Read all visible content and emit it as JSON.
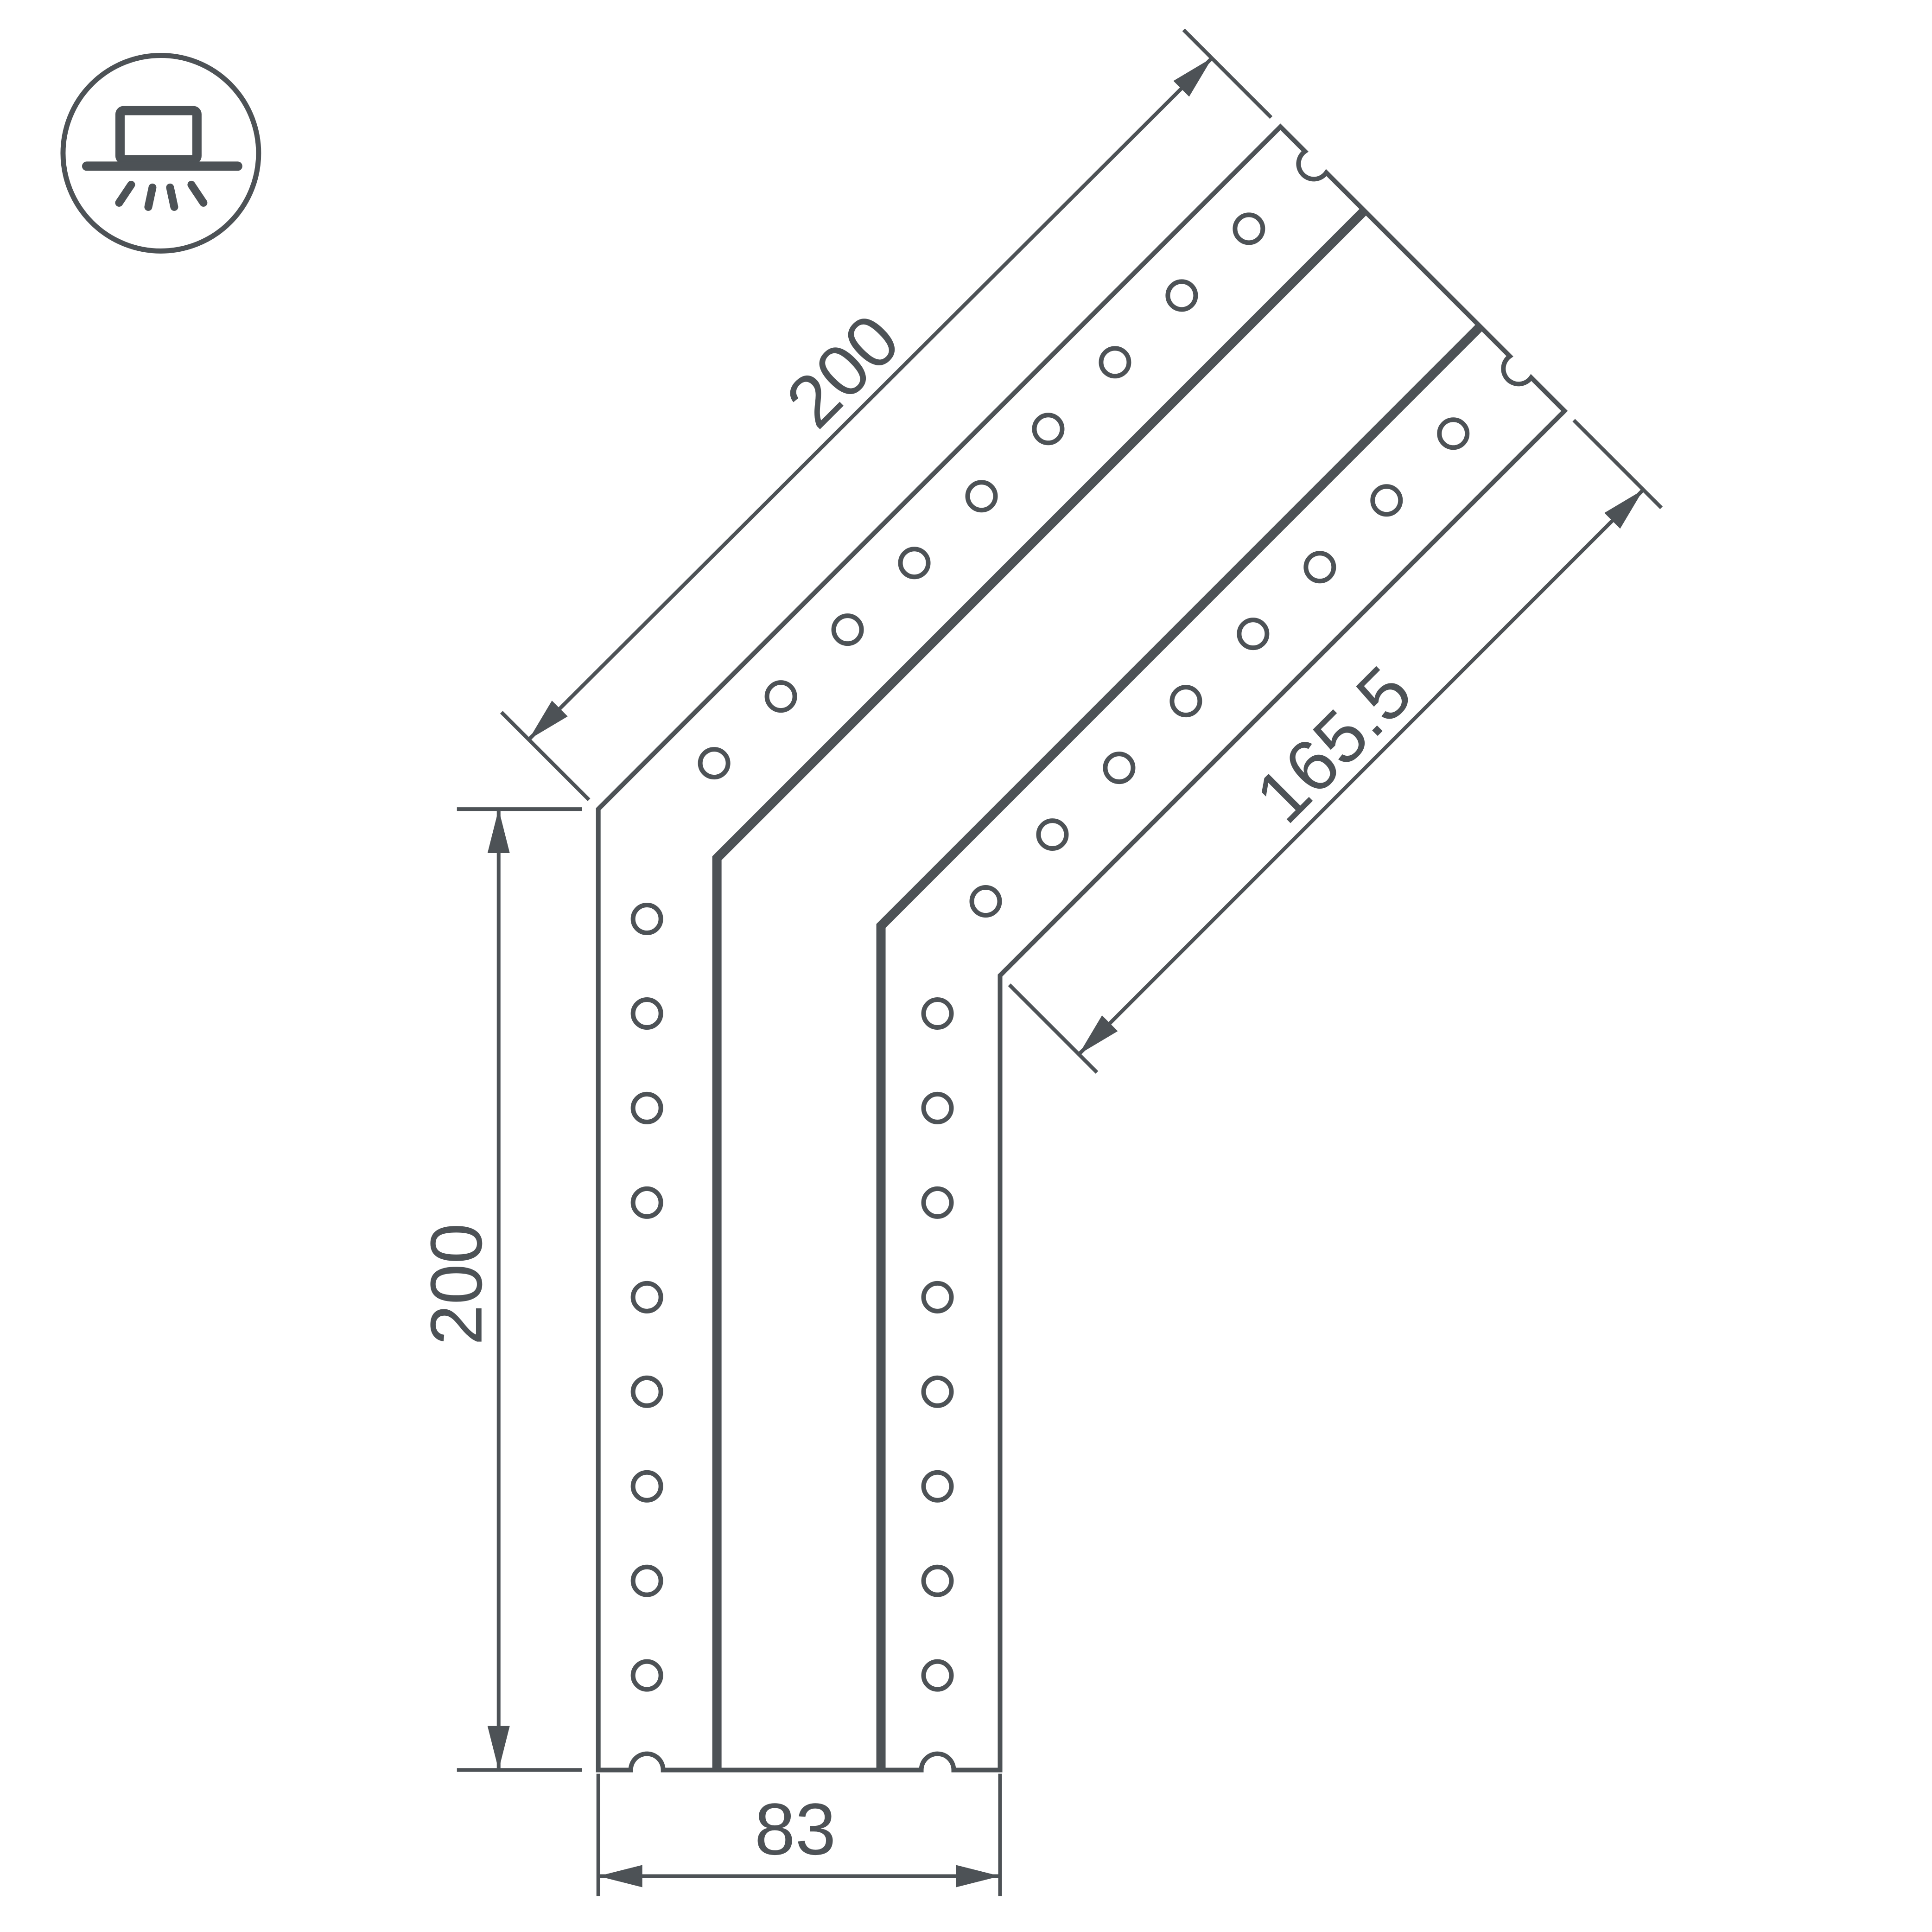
{
  "colors": {
    "line": "#4d5256",
    "background": "#ffffff"
  },
  "drawing": {
    "type": "technical-dimension-drawing",
    "subject": "135-degree corner connector plate with two hole rows and central channel",
    "dimensions": {
      "diagonal_length": "200",
      "vertical_length": "200",
      "inner_diagonal_length": "165.5",
      "bottom_width": "83"
    },
    "icon": {
      "name": "surface-mount-light",
      "description": "luminaire mounted on surface with light rays below"
    }
  }
}
